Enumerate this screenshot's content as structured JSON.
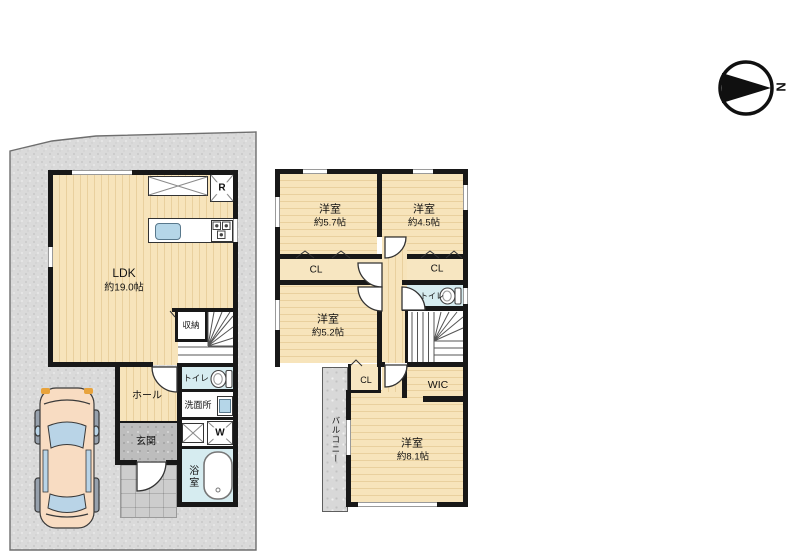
{
  "compass": {
    "north": "N"
  },
  "floor1": {
    "ldk": {
      "name": "LDK",
      "area": "約19.0帖"
    },
    "storage": {
      "label": "収納"
    },
    "hall": {
      "label": "ホール"
    },
    "entrance": {
      "label": "玄関"
    },
    "toilet": {
      "label": "トイレ"
    },
    "washroom": {
      "label": "洗面所"
    },
    "washer": {
      "label": "W"
    },
    "refrigerator": {
      "label": "R"
    },
    "bathroom": {
      "label": "浴室"
    }
  },
  "floor2": {
    "bedroom_a": {
      "name": "洋室",
      "area": "約5.7帖"
    },
    "bedroom_b": {
      "name": "洋室",
      "area": "約4.5帖"
    },
    "bedroom_c": {
      "name": "洋室",
      "area": "約5.2帖"
    },
    "bedroom_d": {
      "name": "洋室",
      "area": "約8.1帖"
    },
    "closet_a": {
      "label": "CL"
    },
    "closet_b": {
      "label": "CL"
    },
    "closet_c": {
      "label": "CL"
    },
    "toilet": {
      "label": "トイレ"
    },
    "wic": {
      "label": "WIC"
    },
    "balcony": {
      "label": "バルコニー"
    }
  },
  "colors": {
    "wall": "#181818",
    "wood": "#f7e4bb",
    "water_room": "#d6ecf0",
    "site": "#d8d8d8",
    "sink": "#b5d6e8"
  }
}
